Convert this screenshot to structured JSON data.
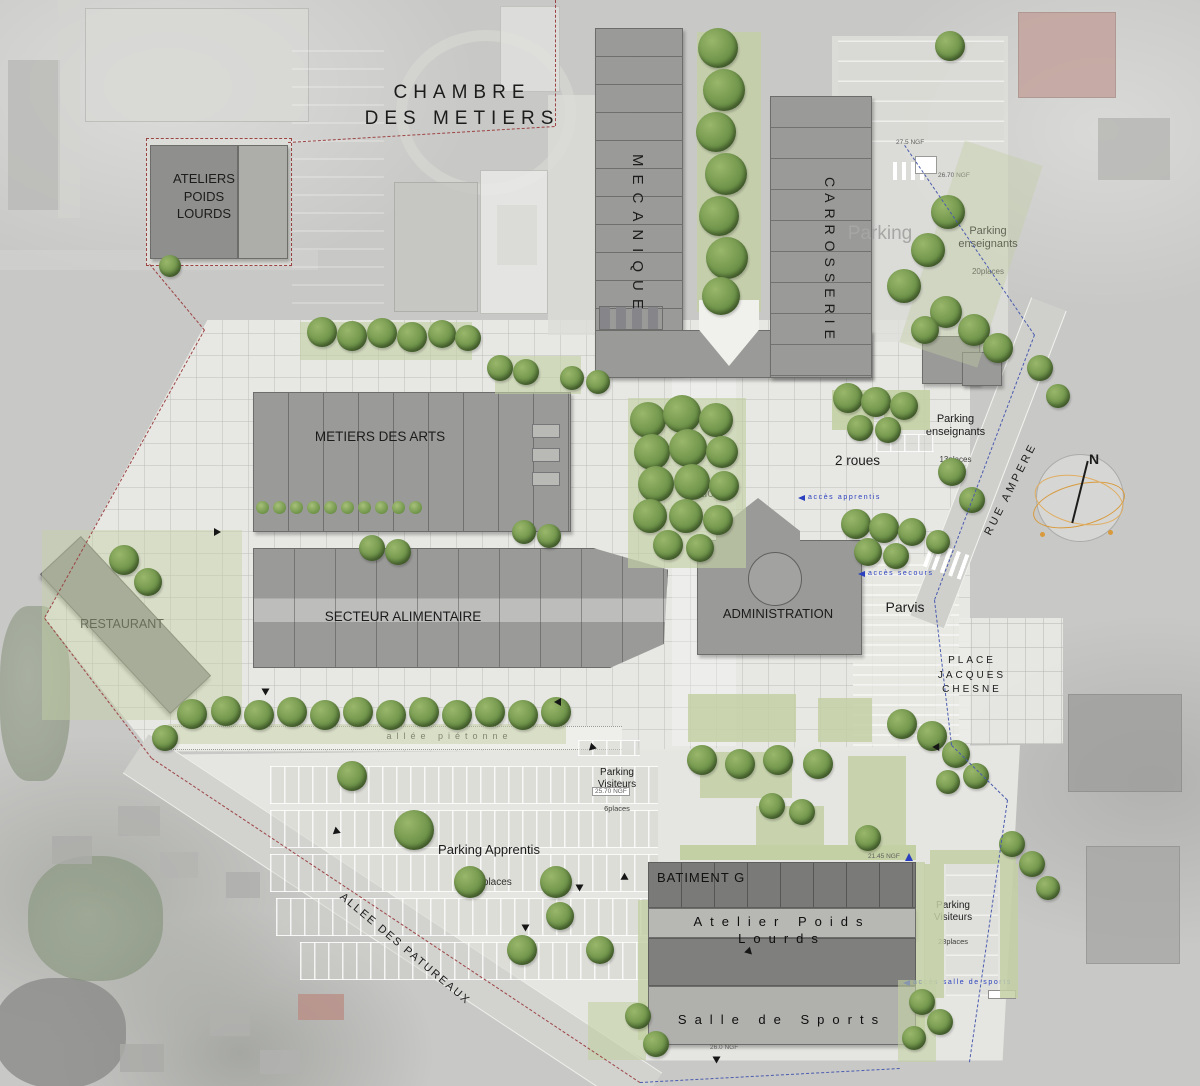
{
  "meta": {
    "plan_type": "architectural site plan",
    "width_px": 1200,
    "height_px": 1086
  },
  "colors": {
    "background_photo": "#c8c8c6",
    "paving": "#e9e9e5",
    "building": "#9a9a98",
    "building_roof_dark": "#7a7a78",
    "tree": "#6b9147",
    "lawn": "#c3d0a4",
    "boundary_red": "#9c4444",
    "boundary_blue": "#4a5cae",
    "access_text_blue": "#2b40bf",
    "compass_orange": "#d89a3c"
  },
  "buildings": {
    "chambre_des_metiers": {
      "label": "CHAMBRE\nDES METIERS"
    },
    "ateliers_poids_lourds": {
      "label": "ATELIERS\nPOIDS\nLOURDS"
    },
    "mecanique": {
      "label": "MECANIQUE"
    },
    "carrosserie": {
      "label": "CARROSSERIE"
    },
    "metiers_des_arts": {
      "label": "METIERS DES ARTS"
    },
    "secteur_alimentaire": {
      "label": "SECTEUR ALIMENTAIRE"
    },
    "administration": {
      "label": "ADMINISTRATION"
    },
    "restaurant": {
      "label": "RESTAURANT"
    },
    "batiment_g": {
      "label": "BATIMENT G"
    },
    "atelier_poids_lourds": {
      "label": "Atelier Poids Lourds"
    },
    "salle_de_sports": {
      "label": "Salle de Sports"
    }
  },
  "parking": {
    "existing": {
      "label": "Parking"
    },
    "enseignants_nord": {
      "label": "Parking\nenseignants",
      "places": "20places"
    },
    "enseignants_est": {
      "label": "Parking\nenseignants",
      "places": "13places"
    },
    "deux_roues": {
      "label": "2 roues"
    },
    "visiteurs_nord": {
      "label": "Parking\nVisiteurs",
      "places": "6places"
    },
    "apprentis": {
      "label": "Parking Apprentis",
      "places": "125places"
    },
    "visiteurs_sud": {
      "label": "Parking\nVisiteurs",
      "places": "28places"
    }
  },
  "open_spaces": {
    "patio": {
      "label": "Patio"
    },
    "parvis": {
      "label": "Parvis"
    },
    "place_jacques_chesne": {
      "label": "PLACE\nJACQUES\nCHESNE"
    },
    "allee_pietonne": {
      "label": "allée piétonne"
    }
  },
  "streets": {
    "rue_ampere": {
      "label": "RUE AMPERE"
    },
    "allee_des_patureaux": {
      "label": "ALLEE DES PATUREAUX"
    }
  },
  "access_points": {
    "apprentis": {
      "label": "accès apprentis"
    },
    "secours": {
      "label": "accès secours"
    },
    "salle_de_sports": {
      "label": "accès salle de sports"
    }
  },
  "annotations": {
    "north": "N",
    "spot_elevations": [
      "27.5 NGF",
      "26.70 NGF",
      "25.70 NGF",
      "21.45 NGF",
      "26.0 NGF"
    ]
  }
}
